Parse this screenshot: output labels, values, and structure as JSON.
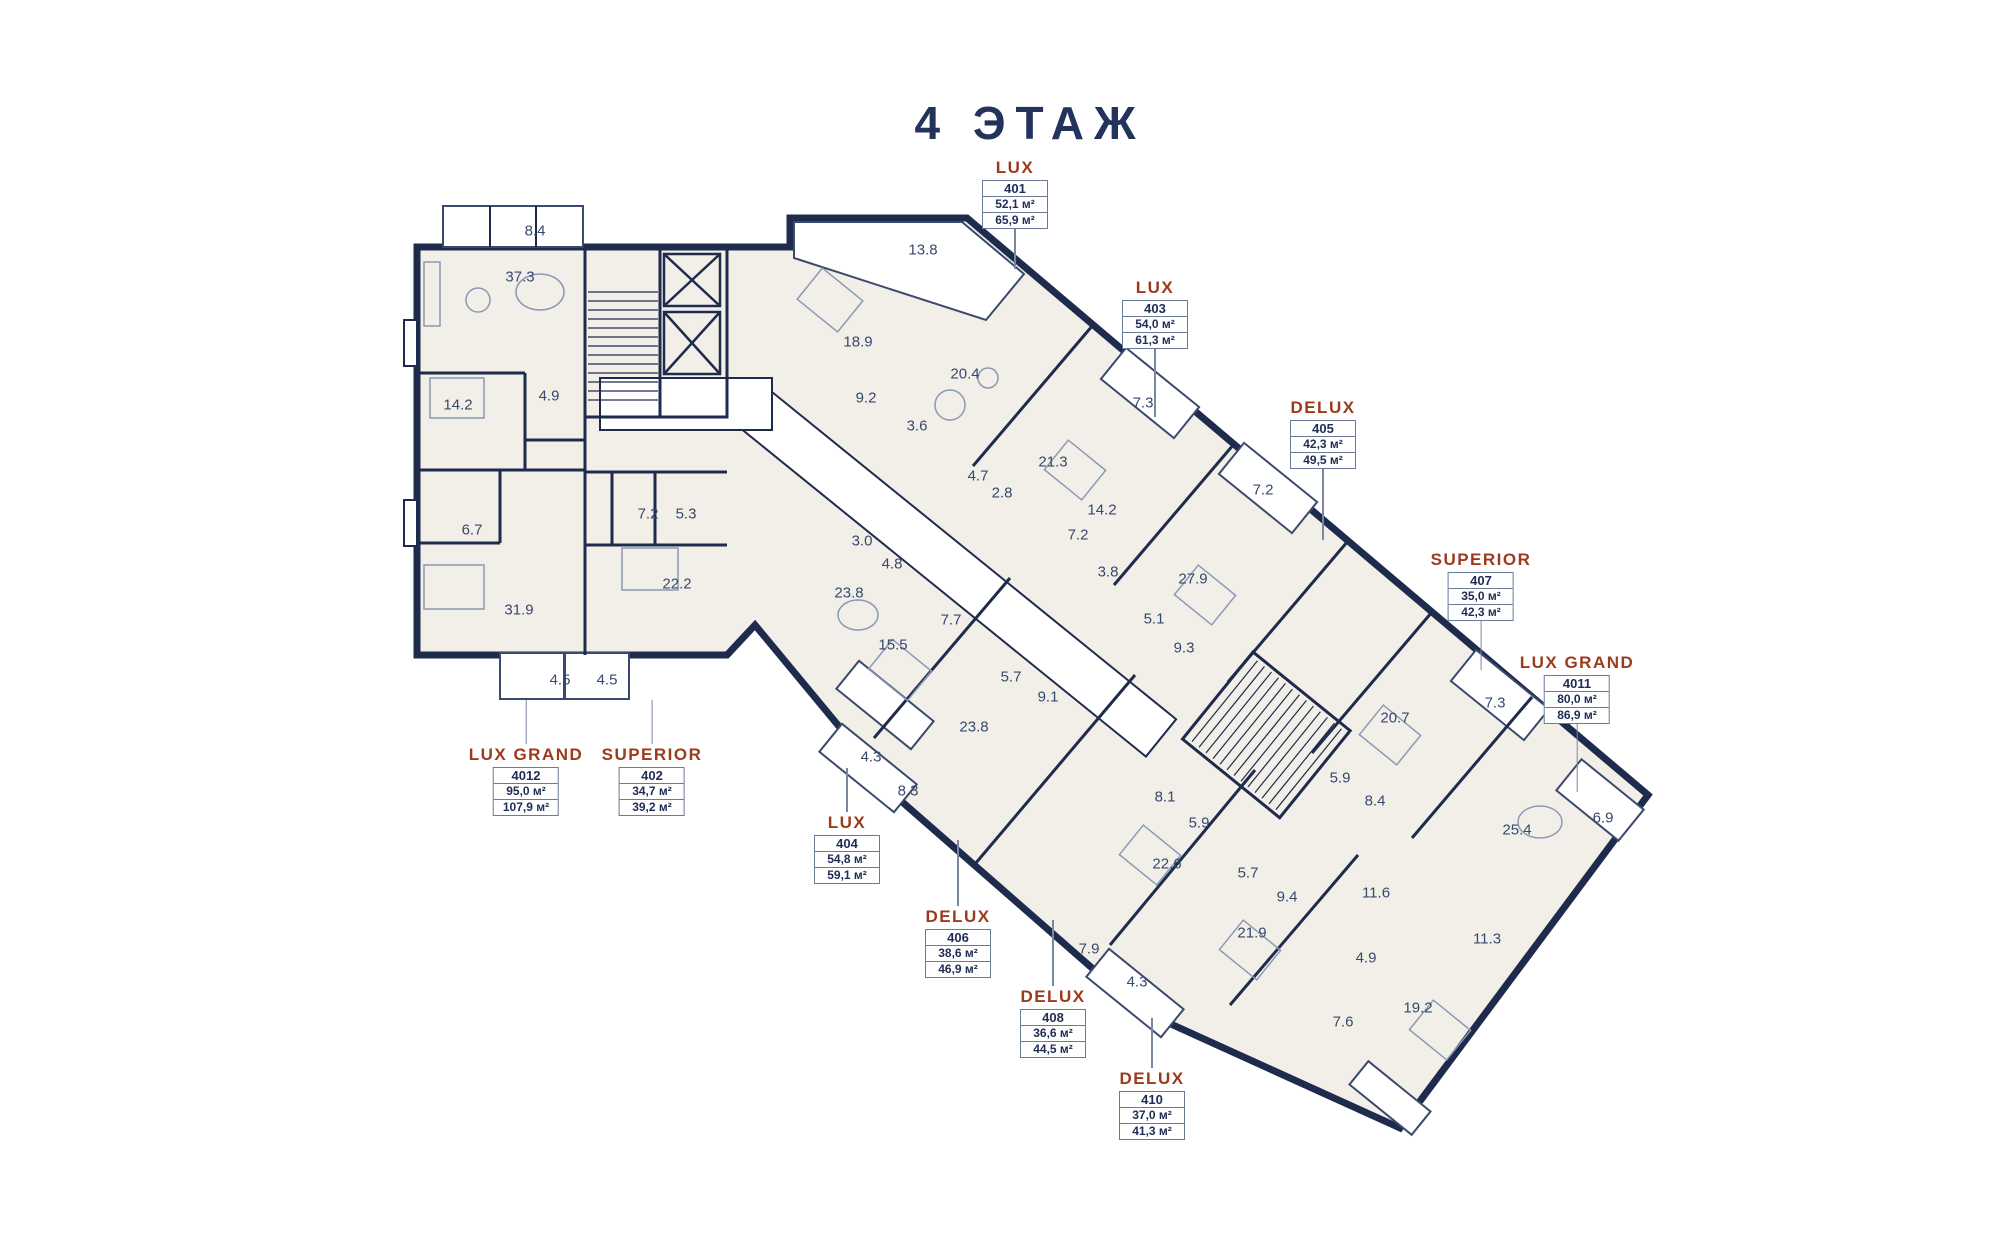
{
  "title": "4 ЭТАЖ",
  "palette": {
    "wall": "#1e2b4c",
    "room_fill": "#f2efe8",
    "accent_label": "#9c3a1c",
    "box_border": "#6a7a99",
    "number_text": "#36496e",
    "background": "#ffffff"
  },
  "units": [
    {
      "type": "LUX",
      "number": "401",
      "area1": "52,1 м²",
      "area2": "65,9 м²",
      "x": 1015,
      "y": 157,
      "leader_bottom": 40
    },
    {
      "type": "LUX",
      "number": "403",
      "area1": "54,0 м²",
      "area2": "61,3 м²",
      "x": 1155,
      "y": 277,
      "leader_bottom": 68
    },
    {
      "type": "DELUX",
      "number": "405",
      "area1": "42,3 м²",
      "area2": "49,5 м²",
      "x": 1323,
      "y": 397,
      "leader_bottom": 71
    },
    {
      "type": "SUPERIOR",
      "number": "407",
      "area1": "35,0 м²",
      "area2": "42,3 м²",
      "x": 1481,
      "y": 549,
      "leader_bottom": 49
    },
    {
      "type": "LUX GRAND",
      "number": "4011",
      "area1": "80,0 м²",
      "area2": "86,9 м²",
      "x": 1577,
      "y": 652,
      "leader_bottom": 68
    },
    {
      "type": "LUX GRAND",
      "number": "4012",
      "area1": "95,0 м²",
      "area2": "107,9 м²",
      "x": 526,
      "y": 700,
      "leader_top": 44
    },
    {
      "type": "SUPERIOR",
      "number": "402",
      "area1": "34,7 м²",
      "area2": "39,2 м²",
      "x": 652,
      "y": 700,
      "leader_top": 44
    },
    {
      "type": "LUX",
      "number": "404",
      "area1": "54,8 м²",
      "area2": "59,1 м²",
      "x": 847,
      "y": 768,
      "leader_top": 44
    },
    {
      "type": "DELUX",
      "number": "406",
      "area1": "38,6 м²",
      "area2": "46,9 м²",
      "x": 958,
      "y": 840,
      "leader_top": 66
    },
    {
      "type": "DELUX",
      "number": "408",
      "area1": "36,6 м²",
      "area2": "44,5 м²",
      "x": 1053,
      "y": 920,
      "leader_top": 66
    },
    {
      "type": "DELUX",
      "number": "410",
      "area1": "37,0 м²",
      "area2": "41,3 м²",
      "x": 1152,
      "y": 1018,
      "leader_top": 50
    }
  ],
  "rooms": [
    {
      "v": "8.4",
      "x": 535,
      "y": 231
    },
    {
      "v": "37.3",
      "x": 520,
      "y": 277
    },
    {
      "v": "14.2",
      "x": 458,
      "y": 405
    },
    {
      "v": "4.9",
      "x": 549,
      "y": 396
    },
    {
      "v": "6.7",
      "x": 472,
      "y": 530
    },
    {
      "v": "31.9",
      "x": 519,
      "y": 610
    },
    {
      "v": "4.5",
      "x": 560,
      "y": 680
    },
    {
      "v": "4.5",
      "x": 607,
      "y": 680
    },
    {
      "v": "7.2",
      "x": 648,
      "y": 514
    },
    {
      "v": "5.3",
      "x": 686,
      "y": 514
    },
    {
      "v": "22.2",
      "x": 677,
      "y": 584
    },
    {
      "v": "13.8",
      "x": 923,
      "y": 250
    },
    {
      "v": "18.9",
      "x": 858,
      "y": 342
    },
    {
      "v": "20.4",
      "x": 965,
      "y": 374
    },
    {
      "v": "9.2",
      "x": 866,
      "y": 398
    },
    {
      "v": "3.6",
      "x": 917,
      "y": 426
    },
    {
      "v": "4.7",
      "x": 978,
      "y": 476
    },
    {
      "v": "2.8",
      "x": 1002,
      "y": 493
    },
    {
      "v": "21.3",
      "x": 1053,
      "y": 462
    },
    {
      "v": "7.3",
      "x": 1143,
      "y": 403
    },
    {
      "v": "14.2",
      "x": 1102,
      "y": 510
    },
    {
      "v": "7.2",
      "x": 1078,
      "y": 535
    },
    {
      "v": "3.8",
      "x": 1108,
      "y": 572
    },
    {
      "v": "27.9",
      "x": 1193,
      "y": 579
    },
    {
      "v": "5.1",
      "x": 1154,
      "y": 619
    },
    {
      "v": "9.3",
      "x": 1184,
      "y": 648
    },
    {
      "v": "7.2",
      "x": 1263,
      "y": 490
    },
    {
      "v": "3.0",
      "x": 862,
      "y": 541
    },
    {
      "v": "4.8",
      "x": 892,
      "y": 564
    },
    {
      "v": "23.8",
      "x": 849,
      "y": 593
    },
    {
      "v": "7.7",
      "x": 951,
      "y": 620
    },
    {
      "v": "15.5",
      "x": 893,
      "y": 645
    },
    {
      "v": "5.7",
      "x": 1011,
      "y": 677
    },
    {
      "v": "9.1",
      "x": 1048,
      "y": 697
    },
    {
      "v": "23.8",
      "x": 974,
      "y": 727
    },
    {
      "v": "4.3",
      "x": 871,
      "y": 757
    },
    {
      "v": "8.3",
      "x": 908,
      "y": 791
    },
    {
      "v": "8.1",
      "x": 1165,
      "y": 797
    },
    {
      "v": "5.9",
      "x": 1199,
      "y": 823
    },
    {
      "v": "22.6",
      "x": 1167,
      "y": 864
    },
    {
      "v": "5.7",
      "x": 1248,
      "y": 873
    },
    {
      "v": "9.4",
      "x": 1287,
      "y": 897
    },
    {
      "v": "7.9",
      "x": 1089,
      "y": 949
    },
    {
      "v": "4.3",
      "x": 1137,
      "y": 982
    },
    {
      "v": "21.9",
      "x": 1252,
      "y": 933
    },
    {
      "v": "7.3",
      "x": 1495,
      "y": 703
    },
    {
      "v": "20.7",
      "x": 1395,
      "y": 718
    },
    {
      "v": "5.9",
      "x": 1340,
      "y": 778
    },
    {
      "v": "8.4",
      "x": 1375,
      "y": 801
    },
    {
      "v": "25.4",
      "x": 1517,
      "y": 830
    },
    {
      "v": "6.9",
      "x": 1603,
      "y": 818
    },
    {
      "v": "11.6",
      "x": 1376,
      "y": 893
    },
    {
      "v": "11.3",
      "x": 1487,
      "y": 939
    },
    {
      "v": "4.9",
      "x": 1366,
      "y": 958
    },
    {
      "v": "7.6",
      "x": 1343,
      "y": 1022
    },
    {
      "v": "19.2",
      "x": 1418,
      "y": 1008
    }
  ]
}
